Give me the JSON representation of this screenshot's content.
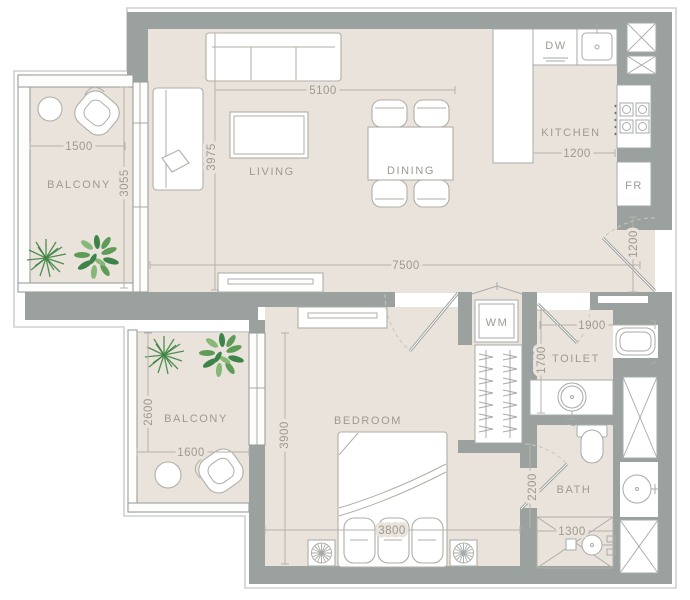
{
  "plan": {
    "rooms": {
      "living": "LIVING",
      "dining": "DINING",
      "kitchen": "KITCHEN",
      "bedroom": "BEDROOM",
      "toilet": "TOILET",
      "bath": "BATH",
      "balcony_top": "BALCONY",
      "balcony_bottom": "BALCONY"
    },
    "appliances": {
      "dishwasher": "DW",
      "fridge": "FR",
      "washing_machine": "WM"
    },
    "dimensions_mm": {
      "living_width": "5100",
      "living_depth": "3975",
      "balcony_top_width": "1500",
      "balcony_top_depth": "3055",
      "overall_width": "7500",
      "kitchen_width": "1200",
      "entry_width": "1200",
      "toilet_width": "1900",
      "toilet_depth": "1700",
      "balcony_bottom_depth": "2600",
      "balcony_bottom_width": "1600",
      "bedroom_depth": "3900",
      "bedroom_width": "3800",
      "bath_depth": "2200",
      "shower_width": "1300"
    },
    "colors": {
      "wall": "#9ba19e",
      "floor": "#eae3db",
      "dimension_line": "#b5b2ab",
      "text": "#9b9992",
      "plant_green": "#4f8f4f"
    }
  }
}
